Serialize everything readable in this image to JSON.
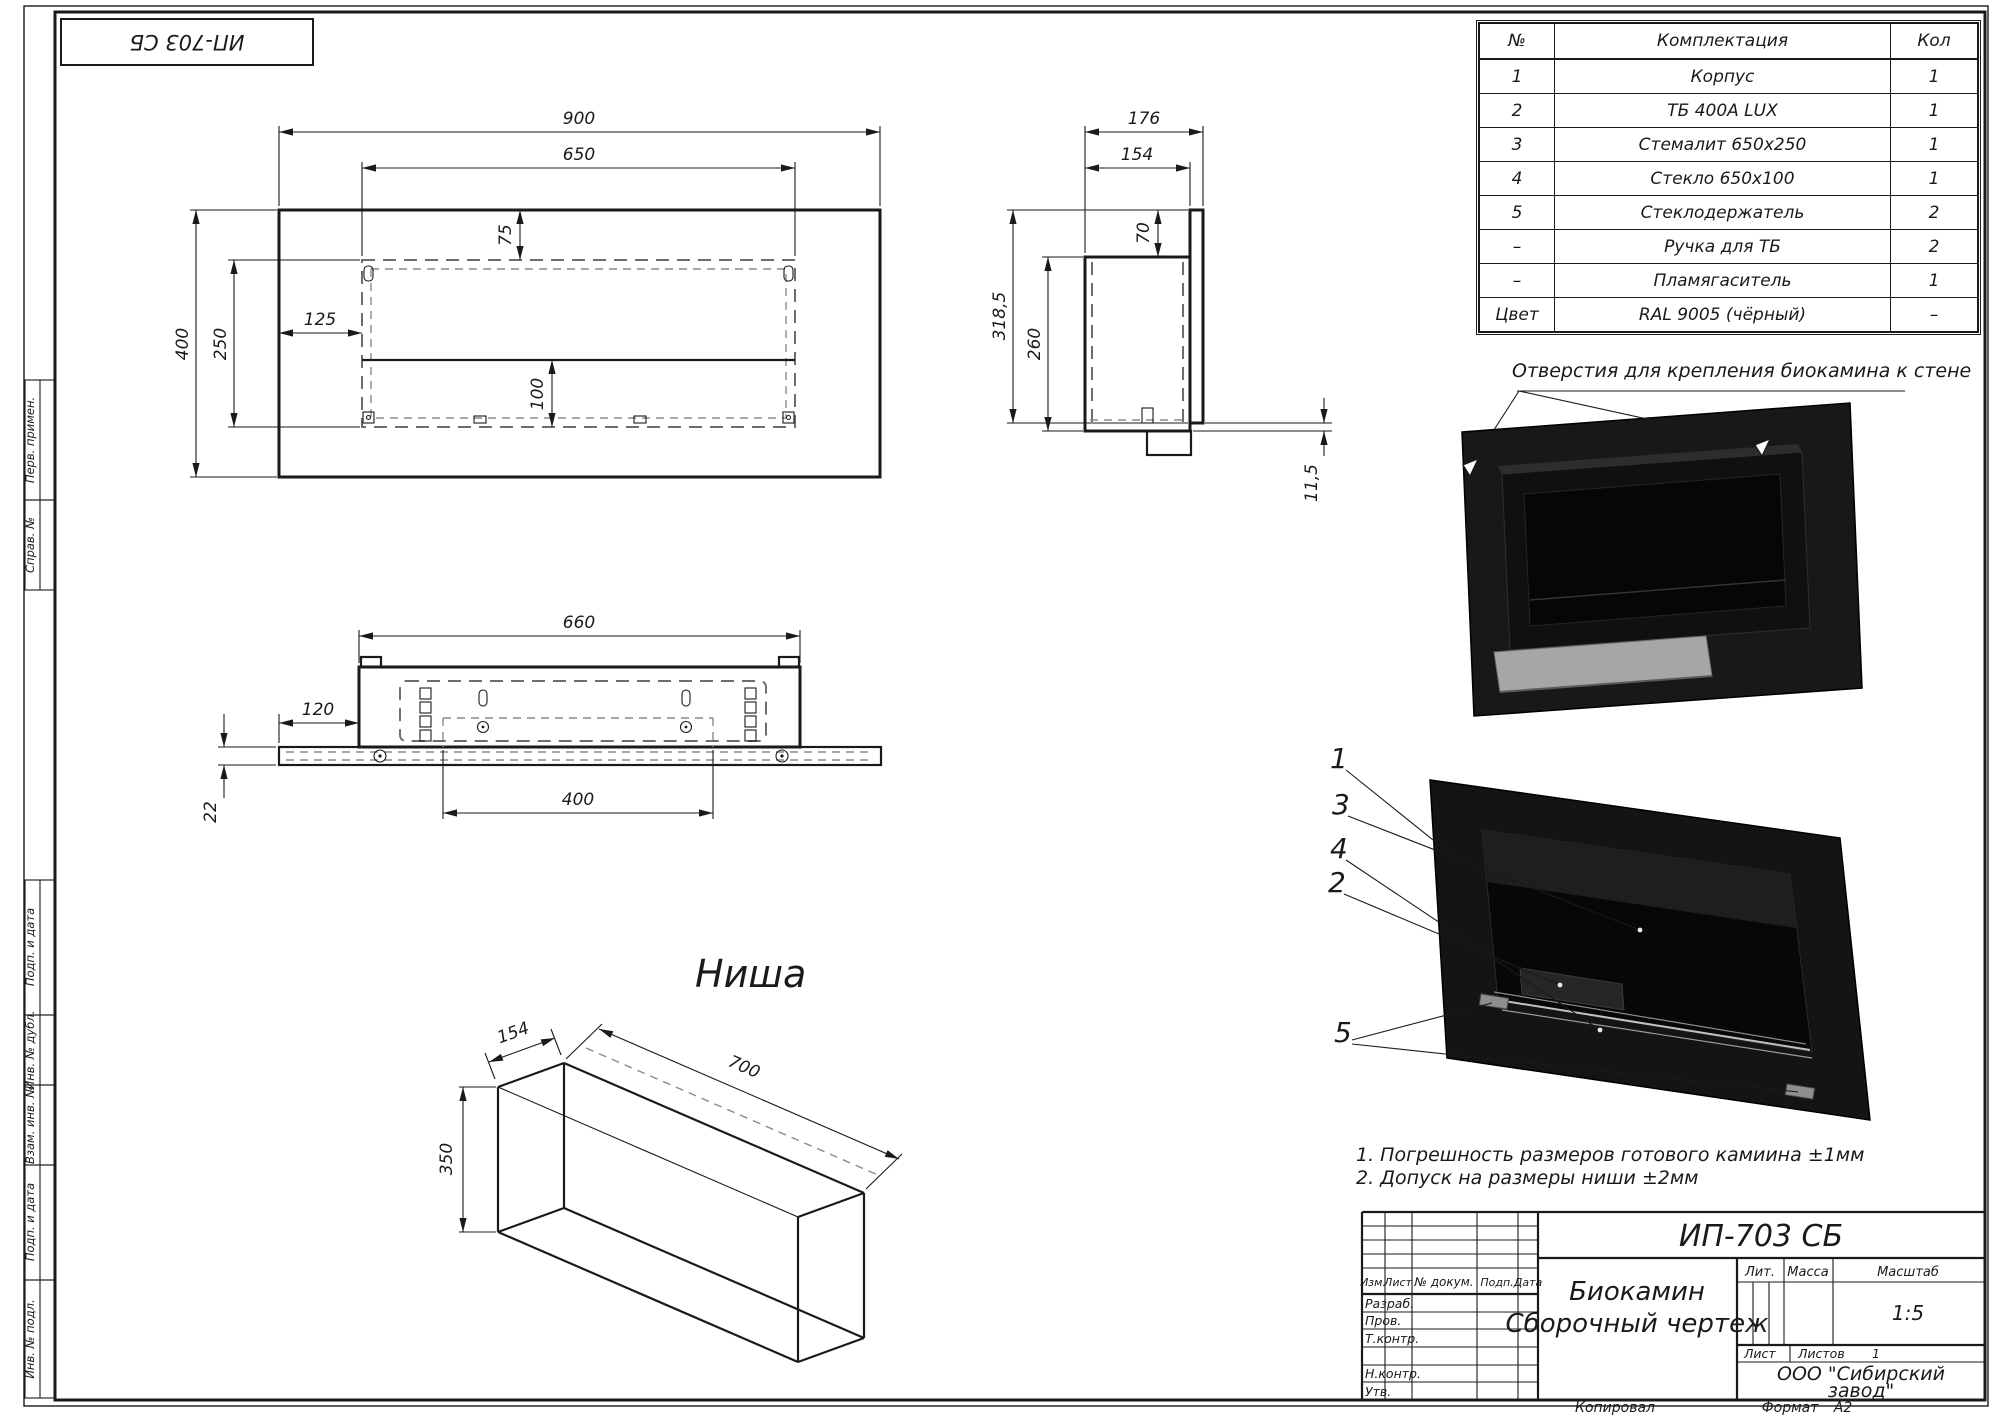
{
  "page": {
    "corner_stamp": "ИП-703 СБ",
    "colors": {
      "line": "#1a1a1a",
      "dashed": "#6e6e6e",
      "render_black": "#161616",
      "steel": "#a6a6a6"
    }
  },
  "parts_table": {
    "headers": [
      "№",
      "Комплектация",
      "Кол"
    ],
    "rows": [
      [
        "1",
        "Корпус",
        "1"
      ],
      [
        "2",
        "ТБ 400А LUX",
        "1"
      ],
      [
        "3",
        "Стемалит 650х250",
        "1"
      ],
      [
        "4",
        "Стекло 650х100",
        "1"
      ],
      [
        "5",
        "Стеклодержатель",
        "2"
      ],
      [
        "–",
        "Ручка для ТБ",
        "2"
      ],
      [
        "–",
        "Пламягаситель",
        "1"
      ],
      [
        "Цвет",
        "RAL 9005 (чёрный)",
        "–"
      ]
    ]
  },
  "annotations": {
    "mount_holes": "Отверстия для крепления биокамина к стене",
    "niche_title": "Ниша"
  },
  "notes": {
    "line1": "1. Погрешность размеров готового камиина ±1мм",
    "line2": "2. Допуск на размеры ниши ±2мм"
  },
  "margin_labels": [
    "Перв. примен.",
    "Справ. №",
    "Подп. и дата",
    "Инв. № дубл.",
    "Взам. инв. №",
    "Подп. и дата",
    "Инв. № подл."
  ],
  "dims": {
    "front": {
      "width": "900",
      "opening_width": "650",
      "top_offset": "75",
      "left_offset": "125",
      "height": "400",
      "opening_height": "250",
      "glass_height": "100"
    },
    "side": {
      "total_depth": "176",
      "body_depth": "154",
      "top_offset": "70",
      "plate_height": "318,5",
      "body_height": "260",
      "bottom_offset": "11,5"
    },
    "bottom": {
      "body_width": "660",
      "flange_offset": "120",
      "flange_height": "22",
      "slot_width": "400"
    },
    "niche": {
      "depth": "154",
      "width": "700",
      "height": "350"
    }
  },
  "callouts": [
    "1",
    "3",
    "4",
    "2",
    "5"
  ],
  "title_block": {
    "doc_number": "ИП-703 СБ",
    "name_line1": "Биокамин",
    "name_line2": "Сборочный чертеж",
    "header_cols": [
      "Изм.",
      "Лист",
      "№ докум.",
      "Подп.",
      "Дата"
    ],
    "sig_rows": [
      "Разраб.",
      "Пров.",
      "Т.контр.",
      "Н.контр.",
      "Утв."
    ],
    "lit_label": "Лит.",
    "mass_label": "Масса",
    "scale_label": "Масштаб",
    "scale_value": "1:5",
    "sheet_label": "Лист",
    "sheets_label": "Листов",
    "sheets_value": "1",
    "company_line1": "ООО \"Сибирский",
    "company_line2": "завод\"",
    "copied_label": "Копировал",
    "format_label": "Формат",
    "format_value": "А2"
  }
}
